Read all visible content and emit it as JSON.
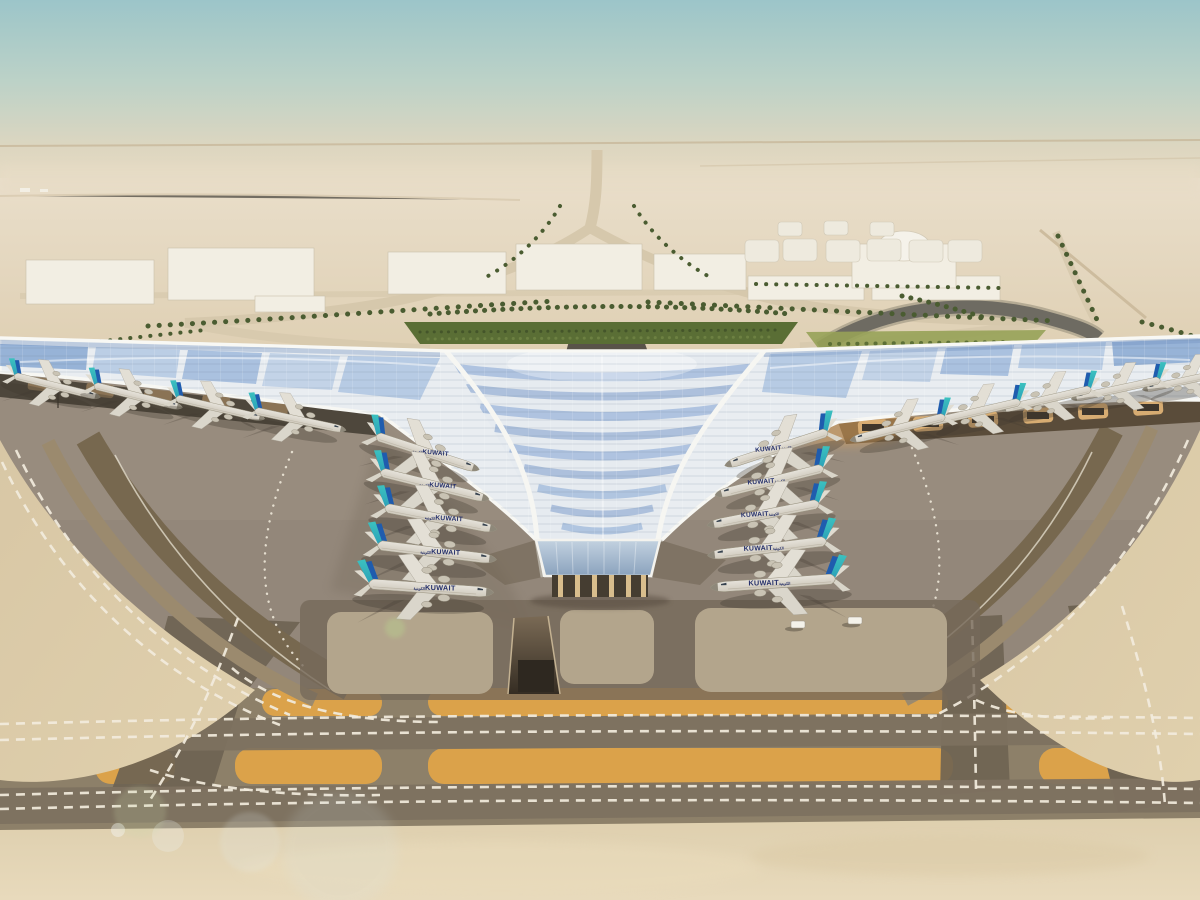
{
  "scene": {
    "type": "architectural-rendering",
    "subject": "Aerial view of a desert airport terminal with a swooping trefoil solar roof, aircraft parked at both piers, taxiways and runway in foreground",
    "time_of_day": "day, hazy desert light"
  },
  "aircraft": {
    "title": "KUWAIT",
    "title_arabic": "الكويتية",
    "count": 19,
    "planes": [
      {
        "x": 55,
        "y": 386,
        "rot": 14,
        "scale": 0.78,
        "flip": false,
        "label": false
      },
      {
        "x": 136,
        "y": 396,
        "rot": 14,
        "scale": 0.8,
        "flip": false,
        "label": false
      },
      {
        "x": 218,
        "y": 408,
        "rot": 13,
        "scale": 0.8,
        "flip": false,
        "label": false
      },
      {
        "x": 298,
        "y": 420,
        "rot": 12,
        "scale": 0.82,
        "flip": false,
        "label": false
      },
      {
        "x": 1188,
        "y": 380,
        "rot": -12,
        "scale": 0.78,
        "flip": true,
        "label": false
      },
      {
        "x": 1118,
        "y": 389,
        "rot": -12,
        "scale": 0.8,
        "flip": true,
        "label": false
      },
      {
        "x": 1048,
        "y": 399,
        "rot": -13,
        "scale": 0.82,
        "flip": true,
        "label": false
      },
      {
        "x": 976,
        "y": 412,
        "rot": -13,
        "scale": 0.84,
        "flip": true,
        "label": false
      },
      {
        "x": 900,
        "y": 428,
        "rot": -14,
        "scale": 0.86,
        "flip": true,
        "label": false
      },
      {
        "x": 425,
        "y": 452,
        "rot": 18,
        "scale": 0.95,
        "flip": false,
        "label": true
      },
      {
        "x": 432,
        "y": 485,
        "rot": 14,
        "scale": 0.98,
        "flip": false,
        "label": true
      },
      {
        "x": 438,
        "y": 518,
        "rot": 11,
        "scale": 1.0,
        "flip": false,
        "label": true
      },
      {
        "x": 434,
        "y": 552,
        "rot": 7,
        "scale": 1.05,
        "flip": false,
        "label": true
      },
      {
        "x": 428,
        "y": 588,
        "rot": 4,
        "scale": 1.1,
        "flip": false,
        "label": true
      },
      {
        "x": 779,
        "y": 448,
        "rot": -18,
        "scale": 0.95,
        "flip": true,
        "label": true
      },
      {
        "x": 772,
        "y": 481,
        "rot": -14,
        "scale": 0.98,
        "flip": true,
        "label": true
      },
      {
        "x": 766,
        "y": 514,
        "rot": -11,
        "scale": 1.0,
        "flip": true,
        "label": true
      },
      {
        "x": 770,
        "y": 548,
        "rot": -7,
        "scale": 1.05,
        "flip": true,
        "label": true
      },
      {
        "x": 776,
        "y": 583,
        "rot": -4,
        "scale": 1.1,
        "flip": true,
        "label": true
      }
    ]
  },
  "vehicles": [
    {
      "x": 798,
      "y": 624
    },
    {
      "x": 855,
      "y": 620
    }
  ],
  "colors": {
    "sky_top": "#9cc5c9",
    "sky_horizon": "#e7dcc4",
    "desert_far": "#e9deca",
    "desert_near": "#ddcdaf",
    "apron_gray": "#93877a",
    "taxiway_dark": "#6e6352",
    "route_gray": "#7d7160",
    "island_orange": "#dba24a",
    "marking_white": "#f2ecdd",
    "sand_strip": "#e2d3b2",
    "roof_silver": "#e9edf1",
    "pv_blue": "#8fadd4",
    "tail_teal": "#3cc2bf",
    "tail_blue": "#1f5cae",
    "livery_navy": "#25306b",
    "palm_green": "#4a5c31",
    "hedge_green": "#5a6e35",
    "building_white": "#f2eee3",
    "tank_white": "#eeeade",
    "road_tan": "#d6c8ac",
    "canopy_tan": "#d7ac72"
  }
}
